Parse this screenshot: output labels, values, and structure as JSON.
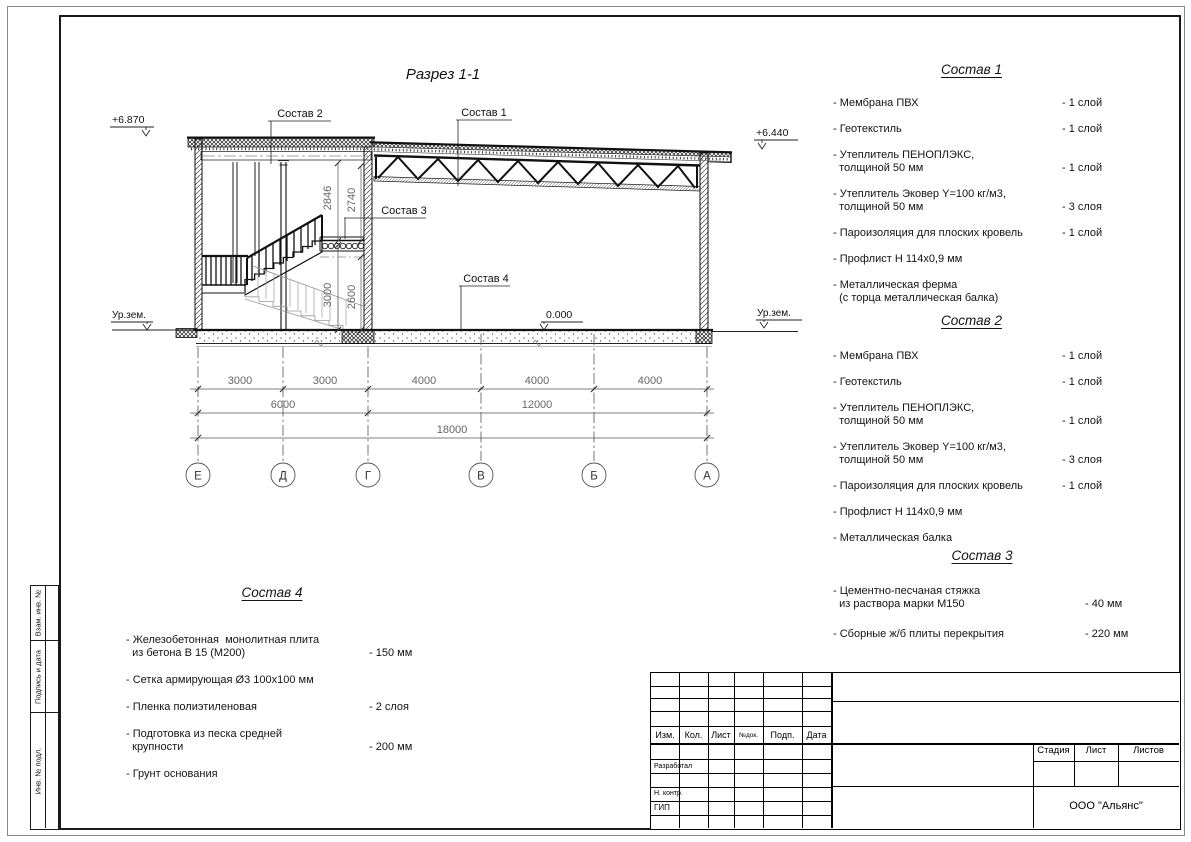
{
  "drawing": {
    "title": "Разрез 1-1",
    "levels": {
      "left_top": "+6.870",
      "right_top": "+6.440",
      "zero": "0.000",
      "ground_left": "Ур.зем.",
      "ground_right": "Ур.зем."
    },
    "leaders": {
      "l1": "Состав 1",
      "l2": "Состав 2",
      "l3": "Состав 3",
      "l4": "Состав 4"
    },
    "vdims": {
      "upper_left": "2846",
      "upper_right": "2740",
      "lower_left": "3000",
      "lower_right": "2600"
    },
    "hdims": {
      "row1": [
        "3000",
        "3000",
        "4000",
        "4000",
        "4000"
      ],
      "row2": [
        "6000",
        "12000"
      ],
      "row3": [
        "18000"
      ]
    },
    "axes": [
      "Е",
      "Д",
      "Г",
      "В",
      "Б",
      "А"
    ]
  },
  "sostav1": {
    "title": "Состав 1",
    "items": [
      {
        "name": "- Мембрана ПВХ",
        "value": "- 1 слой"
      },
      {
        "name": "- Геотекстиль",
        "value": "- 1 слой"
      },
      {
        "name": "- Утеплитель ПЕНОПЛЭКС,\n  толщиной 50 мм",
        "value": "- 1 слой"
      },
      {
        "name": "- Утеплитель Эковер Y=100 кг/м3,\n  толщиной 50 мм",
        "value": "- 3 слоя"
      },
      {
        "name": "- Пароизоляция для плоских кровель",
        "value": "- 1 слой"
      },
      {
        "name": "- Профлист Н 114х0,9 мм",
        "value": ""
      },
      {
        "name": "- Металлическая ферма\n  (с торца металлическая балка)",
        "value": ""
      }
    ]
  },
  "sostav2": {
    "title": "Состав 2",
    "items": [
      {
        "name": "- Мембрана ПВХ",
        "value": "- 1 слой"
      },
      {
        "name": "- Геотекстиль",
        "value": "- 1 слой"
      },
      {
        "name": "- Утеплитель ПЕНОПЛЭКС,\n  толщиной 50 мм",
        "value": "- 1 слой"
      },
      {
        "name": "- Утеплитель Эковер Y=100 кг/м3,\n  толщиной 50 мм",
        "value": "- 3 слоя"
      },
      {
        "name": "- Пароизоляция для плоских кровель",
        "value": "- 1 слой"
      },
      {
        "name": "- Профлист Н 114х0,9 мм",
        "value": ""
      },
      {
        "name": "- Металлическая балка",
        "value": ""
      }
    ]
  },
  "sostav3": {
    "title": "Состав 3",
    "items": [
      {
        "name": "- Цементно-песчаная стяжка\n  из раствора марки М150",
        "value": "- 40 мм"
      },
      {
        "name": "- Сборные ж/б плиты перекрытия",
        "value": "- 220 мм"
      }
    ]
  },
  "sostav4": {
    "title": "Состав 4",
    "items": [
      {
        "name": "- Железобетонная  монолитная плита\n  из бетона В 15 (М200)",
        "value": "- 150 мм"
      },
      {
        "name": "- Сетка армирующая Ø3 100х100 мм",
        "value": ""
      },
      {
        "name": "- Пленка полиэтиленовая",
        "value": "- 2 слоя"
      },
      {
        "name": "- Подготовка из песка средней\n  крупности",
        "value": "- 200 мм"
      },
      {
        "name": "- Грунт основания",
        "value": ""
      }
    ]
  },
  "titleblock": {
    "header_cols": [
      "Изм.",
      "Кол.",
      "Лист",
      "№док.",
      "Подп.",
      "Дата"
    ],
    "role_rows": [
      "Разработал",
      "Н. контр.",
      "ГИП"
    ],
    "stage_cols": [
      "Стадия",
      "Лист",
      "Листов"
    ],
    "company": "ООО \"Альянс\""
  },
  "side_stamp": [
    "Взам. инв. №",
    "Подпись и дата",
    "Инв. № подл."
  ]
}
